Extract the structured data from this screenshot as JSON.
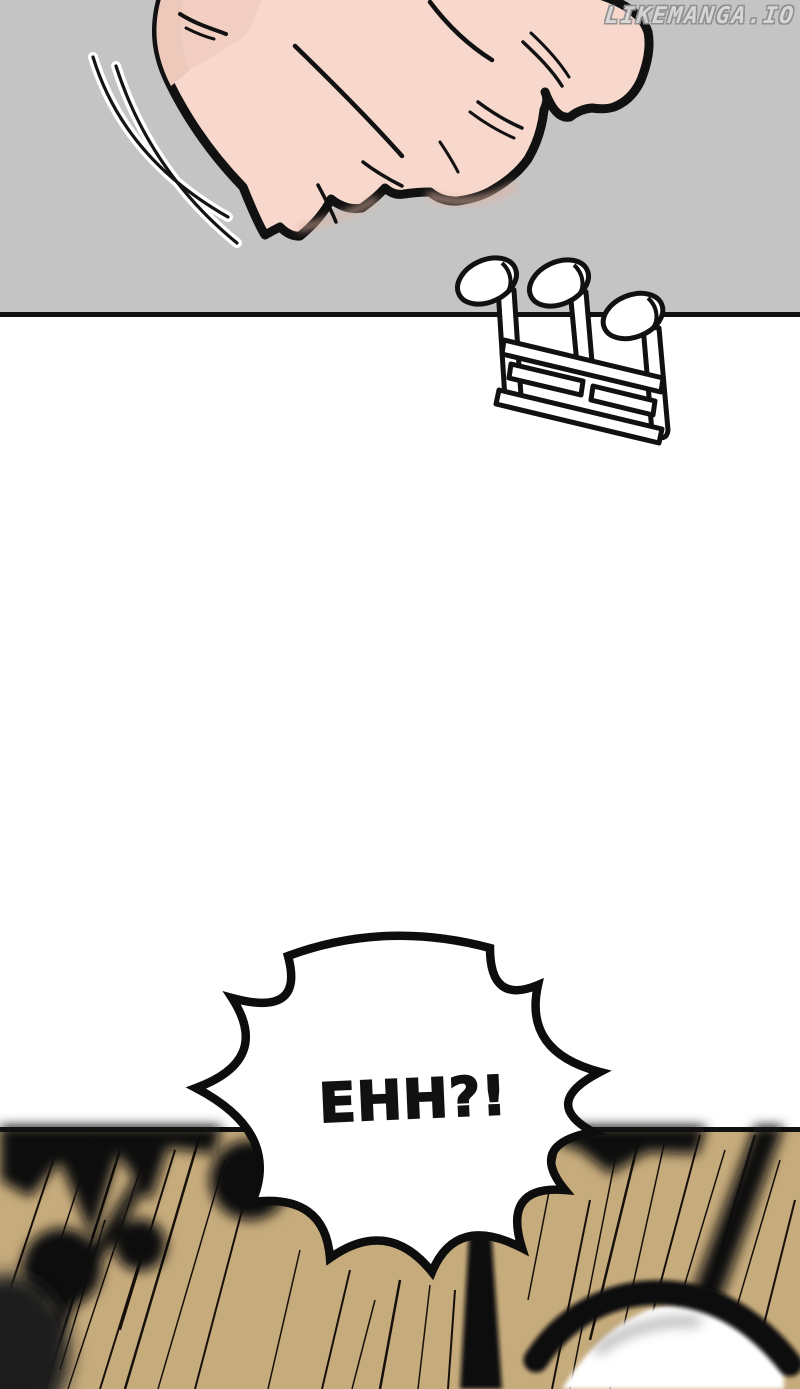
{
  "site": {
    "watermark": "LIKEMANGA.IO"
  },
  "speech_bubble": {
    "text": "EHH?!"
  },
  "sfx": {
    "name": "impact-burst-sfx"
  },
  "panels": {
    "top": {
      "name": "fist-punch-panel"
    },
    "bottom": {
      "name": "eye-closeup-panel"
    }
  },
  "colors": {
    "page_white": "#ffffff",
    "panel_gray": "#c4c4c4",
    "panel_tan": "#c6ab7c",
    "flesh": "#f8d8cd",
    "flesh_shadow": "#ecc9ba",
    "ink": "#111111",
    "watermark_fill": "#d8d8d8",
    "watermark_outline": "#8e8e8e"
  }
}
